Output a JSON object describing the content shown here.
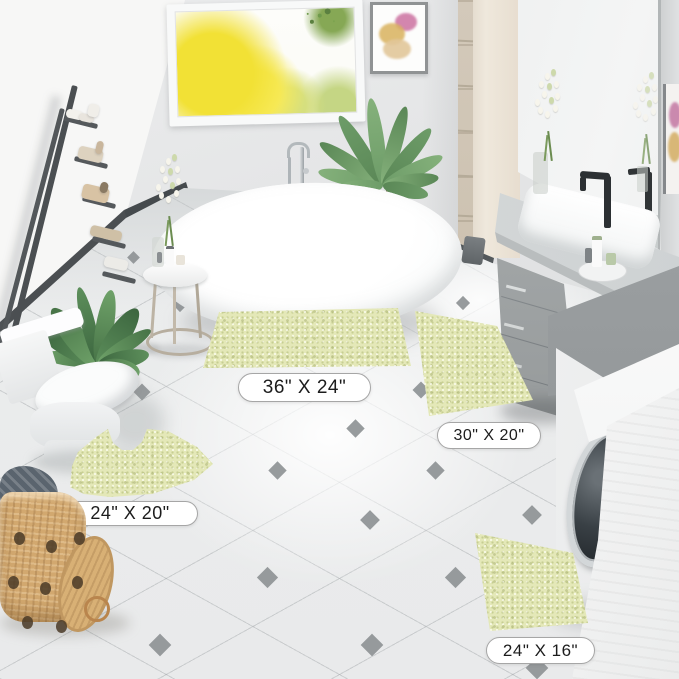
{
  "alt": "Bright bathroom product photo showing a four-piece sage green chenille bath mat set laid on white diamond-tiled floor, with freestanding tub, gray vanity, washing machine, toilet, ladder shelf and plants",
  "size_labels": [
    {
      "id": "mat-36x24",
      "text": "36\" X 24\""
    },
    {
      "id": "mat-30x20",
      "text": "30\" X 20\""
    },
    {
      "id": "mat-contour-24x20",
      "text": "24\" X 20\""
    },
    {
      "id": "mat-24x16",
      "text": "24\" X 16\""
    }
  ],
  "colors": {
    "mat_green": "#e4e8b8",
    "mat_speckle": "#c9d193",
    "tile_accent": "#8e9295",
    "label_text": "#1c1c1c",
    "label_border": "#a6a6a6",
    "wall_gray": "#e3e4e5",
    "wall_white": "#f6f6f5",
    "vanity_gray": "#a7abac",
    "plant_green": "#5d8f5b",
    "window_tree_yellow": "#f2e135",
    "basket_tan": "#d2a86f"
  }
}
